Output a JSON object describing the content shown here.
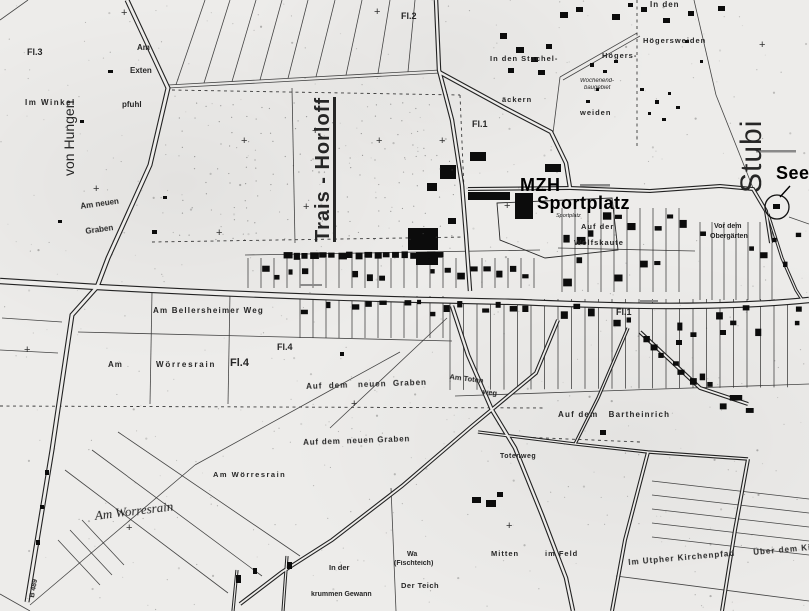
{
  "map": {
    "colors": {
      "paper": "#edecea",
      "ink": "#222222",
      "annotation": "#000000"
    },
    "labels": [
      {
        "id": "fl3",
        "text": "Fl.3",
        "x": 27,
        "y": 48,
        "fs": 9
      },
      {
        "id": "im-winkel",
        "text": "Im Winkel",
        "x": 25,
        "y": 99,
        "fs": 8,
        "ls": 1.5
      },
      {
        "id": "von-hungen",
        "text": "von Hungen",
        "x": 62,
        "y": 176,
        "fs": 14,
        "rot": -90,
        "cls": "big reg"
      },
      {
        "id": "am-extenpfuhl-1",
        "text": "Am",
        "x": 137,
        "y": 44,
        "fs": 8
      },
      {
        "id": "am-extenpfuhl-2",
        "text": "Exten",
        "x": 130,
        "y": 67,
        "fs": 8
      },
      {
        "id": "am-extenpfuhl-3",
        "text": "pfuhl",
        "x": 122,
        "y": 101,
        "fs": 8
      },
      {
        "id": "am-neuen",
        "text": "Am neuen",
        "x": 80,
        "y": 203,
        "fs": 8,
        "rot": -8
      },
      {
        "id": "graben",
        "text": "Graben",
        "x": 85,
        "y": 228,
        "fs": 8,
        "rot": -8
      },
      {
        "id": "fl2",
        "text": "Fl.2",
        "x": 401,
        "y": 12,
        "fs": 9
      },
      {
        "id": "fl1-top",
        "text": "Fl.1",
        "x": 472,
        "y": 120,
        "fs": 9
      },
      {
        "id": "trais-horloff",
        "text": "Trais - Horloff",
        "x": 313,
        "y": 242,
        "fs": 20,
        "ls": 1,
        "rot": -90,
        "cls": "big u"
      },
      {
        "id": "stachel-1",
        "text": "In den Stachel-",
        "x": 490,
        "y": 55,
        "fs": 7.5,
        "ls": 1
      },
      {
        "id": "stachel-2",
        "text": "äckern",
        "x": 502,
        "y": 96,
        "fs": 7.5,
        "ls": 1
      },
      {
        "id": "in-den",
        "text": "In den",
        "x": 650,
        "y": 1,
        "fs": 8,
        "ls": 1
      },
      {
        "id": "hoegersweiden",
        "text": "Högersweiden",
        "x": 643,
        "y": 37,
        "fs": 7.5,
        "ls": 1
      },
      {
        "id": "hoegers",
        "text": "Högers-",
        "x": 602,
        "y": 52,
        "fs": 7.5,
        "ls": 1
      },
      {
        "id": "weiden",
        "text": "weiden",
        "x": 580,
        "y": 109,
        "fs": 7.5,
        "ls": 1
      },
      {
        "id": "wochenend-1",
        "text": "Wochenend-",
        "x": 580,
        "y": 78,
        "fs": 6,
        "cls": "i"
      },
      {
        "id": "wochenend-2",
        "text": "baugebiet",
        "x": 584,
        "y": 85,
        "fs": 6,
        "cls": "i"
      },
      {
        "id": "stubi",
        "text": "Stubi",
        "x": 737,
        "y": 193,
        "fs": 30,
        "ls": 1,
        "rot": -90,
        "cls": "big reg"
      },
      {
        "id": "auf-der",
        "text": "Auf der",
        "x": 581,
        "y": 223,
        "fs": 7.5,
        "ls": 1
      },
      {
        "id": "wolfskaute",
        "text": "Wolfskaute",
        "x": 574,
        "y": 239,
        "fs": 7.5,
        "ls": 1
      },
      {
        "id": "sportplatz-small",
        "text": "Sportplatz",
        "x": 556,
        "y": 214,
        "fs": 5.5,
        "cls": "i"
      },
      {
        "id": "vor-dem",
        "text": "Vor dem",
        "x": 714,
        "y": 223,
        "fs": 7
      },
      {
        "id": "obergaerten",
        "text": "Obergärten",
        "x": 710,
        "y": 233,
        "fs": 7
      },
      {
        "id": "bellersheimer-weg",
        "text": "Am Bellersheimer Weg",
        "x": 153,
        "y": 307,
        "fs": 8,
        "ls": 1.2
      },
      {
        "id": "fl4-a",
        "text": "Fl.4",
        "x": 277,
        "y": 343,
        "fs": 9
      },
      {
        "id": "fl4-b",
        "text": "Fl.4",
        "x": 230,
        "y": 358,
        "fs": 11
      },
      {
        "id": "am-woerresrain-1a",
        "text": "Am",
        "x": 108,
        "y": 361,
        "fs": 8,
        "ls": 1
      },
      {
        "id": "am-woerresrain-1b",
        "text": "Wörresrain",
        "x": 156,
        "y": 361,
        "fs": 8,
        "ls": 1.8
      },
      {
        "id": "fl1-mid",
        "text": "Fl.1",
        "x": 616,
        "y": 308,
        "fs": 9
      },
      {
        "id": "auf-dem-neuen-graben-1",
        "text": "Auf  dem   neuen  Graben",
        "x": 306,
        "y": 383,
        "fs": 8,
        "ls": 1,
        "rot": -2
      },
      {
        "id": "am-toten",
        "text": "Am Toten",
        "x": 450,
        "y": 373,
        "fs": 7.5,
        "rot": 7
      },
      {
        "id": "toten-weg",
        "text": "weg",
        "x": 483,
        "y": 388,
        "fs": 7.5,
        "rot": 7
      },
      {
        "id": "auf-dem-neuen-graben-2",
        "text": "Auf dem  neuen Graben",
        "x": 303,
        "y": 439,
        "fs": 8,
        "ls": 0.8,
        "rot": -2
      },
      {
        "id": "totenweg",
        "text": "Totenweg",
        "x": 500,
        "y": 453,
        "fs": 7,
        "ls": 0.5
      },
      {
        "id": "bartheinrich",
        "text": "Auf dem   Bartheinrich",
        "x": 558,
        "y": 411,
        "fs": 8,
        "ls": 1.2
      },
      {
        "id": "am-woerresrain-2",
        "text": "Am Wörresrain",
        "x": 213,
        "y": 471,
        "fs": 7.5,
        "ls": 1.5
      },
      {
        "id": "am-worresrain-3",
        "text": "Am Worresrain",
        "x": 94,
        "y": 509,
        "fs": 13,
        "rot": -7,
        "cls": "i hand"
      },
      {
        "id": "b489",
        "text": "B 489",
        "x": 29,
        "y": 597,
        "fs": 7,
        "rot": -80
      },
      {
        "id": "in-der",
        "text": "In der",
        "x": 329,
        "y": 564,
        "fs": 7.5
      },
      {
        "id": "krummen-gewann",
        "text": "krummen Gewann",
        "x": 311,
        "y": 591,
        "fs": 7
      },
      {
        "id": "wa",
        "text": "Wa",
        "x": 407,
        "y": 551,
        "fs": 7
      },
      {
        "id": "fischteich",
        "text": "(Fischteich)",
        "x": 394,
        "y": 560,
        "fs": 7
      },
      {
        "id": "der-teich",
        "text": "Der Teich",
        "x": 401,
        "y": 582,
        "fs": 7.5,
        "ls": 0.5
      },
      {
        "id": "mitten",
        "text": "Mitten",
        "x": 491,
        "y": 550,
        "fs": 7.5,
        "ls": 1
      },
      {
        "id": "im-feld",
        "text": "im Feld",
        "x": 545,
        "y": 550,
        "fs": 7.5,
        "ls": 1
      },
      {
        "id": "utpher-kirchenpfad",
        "text": "Im Utpher Kirchenpfad",
        "x": 628,
        "y": 559,
        "fs": 8,
        "ls": 1,
        "rot": -5
      },
      {
        "id": "ueber-dem",
        "text": "Über dem Ki",
        "x": 753,
        "y": 549,
        "fs": 8,
        "ls": 1,
        "rot": -5
      },
      {
        "id": "mzh",
        "text": "MZH",
        "x": 520,
        "y": 176,
        "fs": 18,
        "cls": "ov"
      },
      {
        "id": "sportplatz-bold",
        "text": "Sportplatz",
        "x": 537,
        "y": 194,
        "fs": 18,
        "cls": "ov"
      },
      {
        "id": "see",
        "text": "See",
        "x": 776,
        "y": 164,
        "fs": 18,
        "cls": "ov"
      }
    ],
    "crosses": [
      [
        125,
        14
      ],
      [
        378,
        13
      ],
      [
        763,
        46
      ],
      [
        245,
        142
      ],
      [
        316,
        132
      ],
      [
        307,
        208
      ],
      [
        220,
        234
      ],
      [
        380,
        142
      ],
      [
        443,
        142
      ],
      [
        508,
        207
      ],
      [
        28,
        351
      ],
      [
        130,
        529
      ],
      [
        510,
        527
      ],
      [
        355,
        405
      ],
      [
        97,
        190
      ]
    ]
  }
}
